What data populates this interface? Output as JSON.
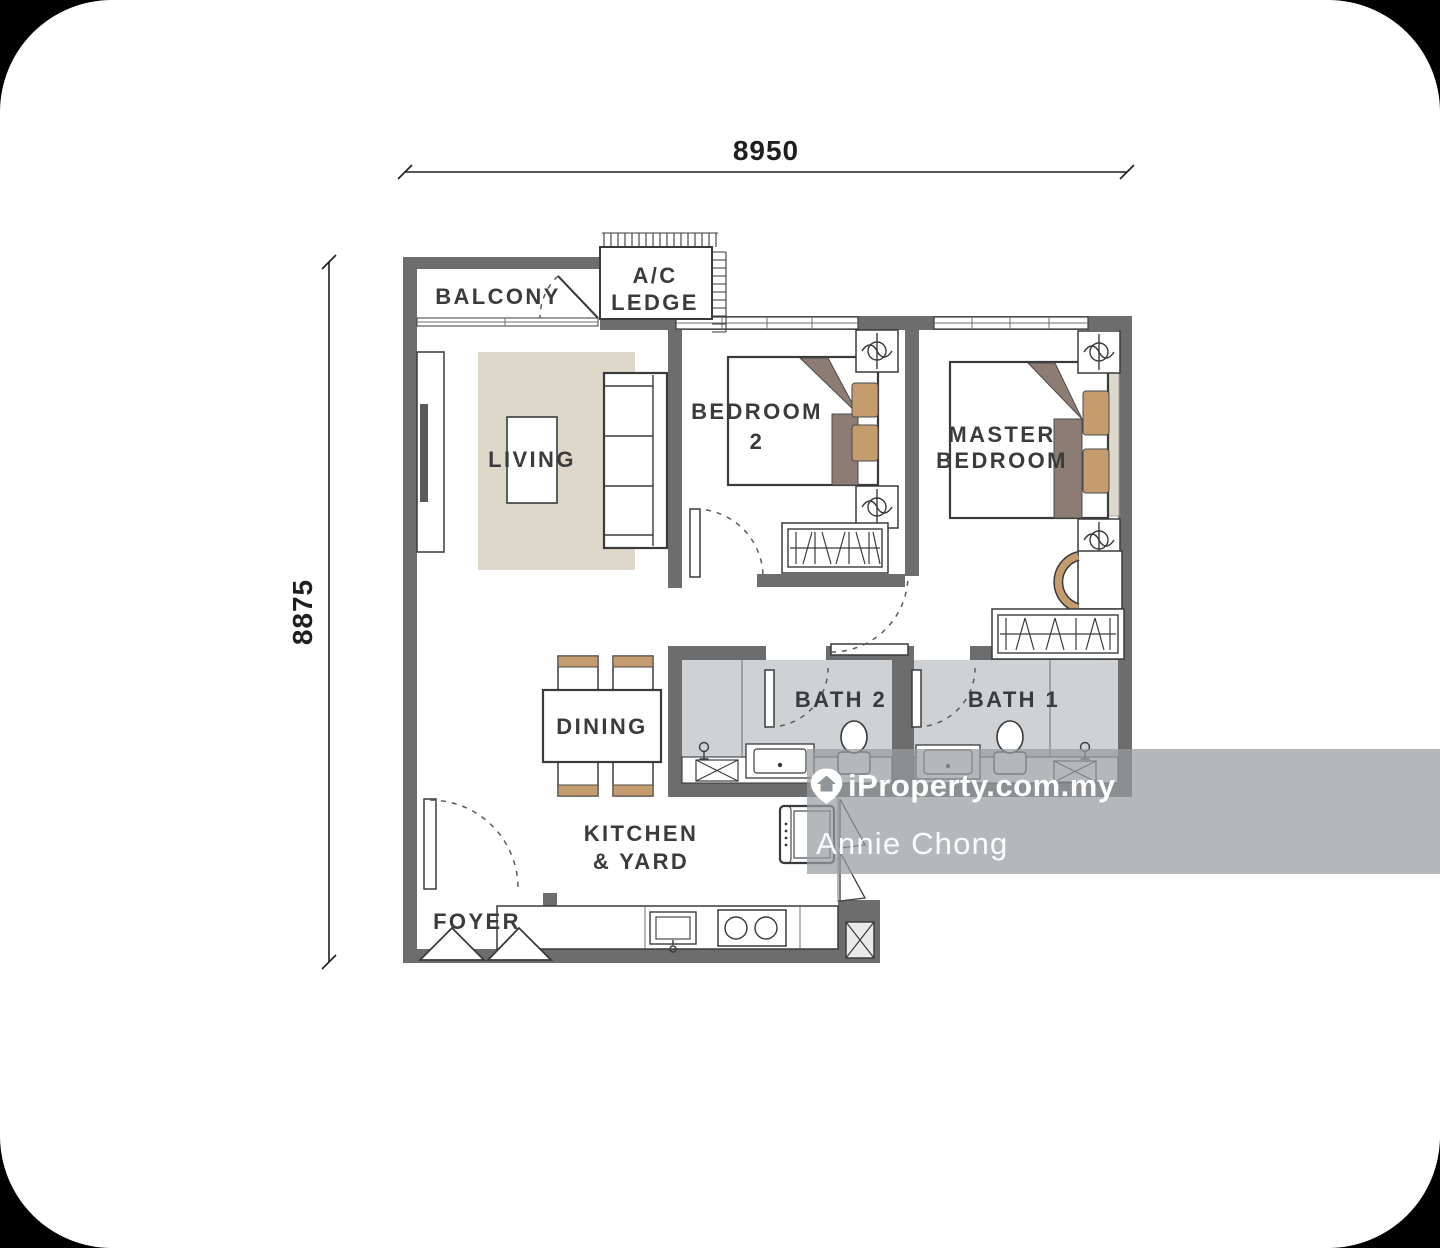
{
  "canvas": {
    "background": "#000000",
    "paper": "#ffffff"
  },
  "dimensions": {
    "top": "8950",
    "left": "8875"
  },
  "rooms": {
    "balcony": {
      "label": "BALCONY"
    },
    "ac_ledge": {
      "line1": "A/C",
      "line2": "LEDGE"
    },
    "living": {
      "label": "LIVING"
    },
    "bedroom2": {
      "line1": "BEDROOM",
      "line2": "2"
    },
    "master_bedroom": {
      "line1": "MASTER",
      "line2": "BEDROOM"
    },
    "dining": {
      "label": "DINING"
    },
    "bath2": {
      "label": "BATH 2"
    },
    "bath1": {
      "label": "BATH 1"
    },
    "kitchen": {
      "line1": "KITCHEN",
      "line2": "& YARD"
    },
    "foyer": {
      "label": "FOYER"
    }
  },
  "watermark": {
    "brand": "iProperty.com.my",
    "agent": "Annie Chong"
  },
  "colors": {
    "wall": "#6d6d6d",
    "bath_floor": "#ced2d4",
    "rug": "#ded8cb",
    "wood": "#c59c6e",
    "blanket": "#8d7c74",
    "watermark_overlay": "rgba(151,156,160,0.72)",
    "tv": "#5a5a5a"
  }
}
